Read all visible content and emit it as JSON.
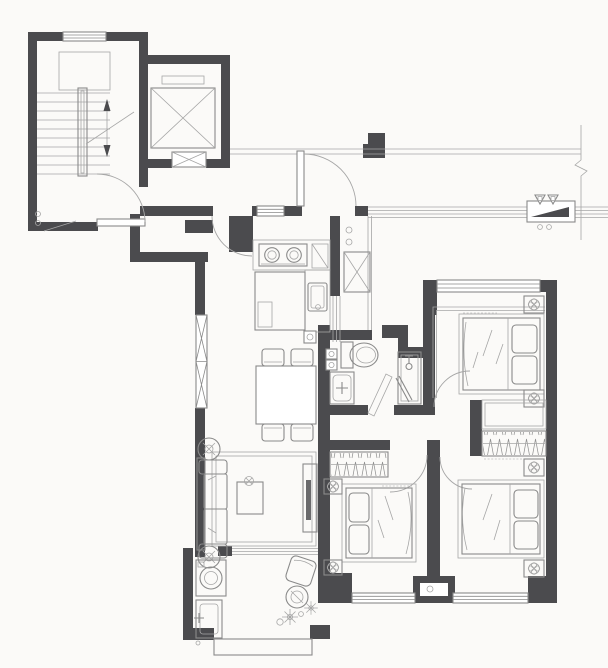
{
  "meta": {
    "title": "apartment-floor-plan",
    "description": "black-and-white architectural floor plan drawing, no text labels visible",
    "image_size": {
      "width": 608,
      "height": 668
    }
  },
  "palette": {
    "bg": "#fbfaf8",
    "wall": "#4b4b4e",
    "line": "#8a8a8a",
    "line2": "#a6a6a6",
    "hatch": "#8f8f8f"
  },
  "areas": [
    {
      "id": "stairwell",
      "label": "staircase with central handrail, treads and up/down arrows"
    },
    {
      "id": "elevator",
      "label": "elevator shaft with X-crossed cab and door symbol"
    },
    {
      "id": "lobby",
      "label": "shared landing lobby with two swing doors"
    },
    {
      "id": "corridor",
      "label": "open-air corridor with pillar, meter box and boundary break line"
    },
    {
      "id": "entry-hall",
      "label": "apartment entry hall with outward swinging entry door"
    },
    {
      "id": "kitchen",
      "label": "kitchen: two-burner gas stove, sink counter, island counter, duct shaft, sliding door, gas pipe circles"
    },
    {
      "id": "bathroom",
      "label": "bathroom: toilet with tank, washbasin with cross faucet, shower with glass door, diagonal threshold"
    },
    {
      "id": "dining",
      "label": "dining area: rectangular table with four chairs, west window with X mullions"
    },
    {
      "id": "living",
      "label": "living room: two-seat sofa, two round planters, area rug, hatched coffee table, TV cabinet"
    },
    {
      "id": "balcony",
      "label": "balcony: washing machine, laundry sink, lounge chair, round table, plants, hatched railing"
    },
    {
      "id": "bedroom-1",
      "label": "north-east bedroom: double bed head east, two nightstand lamps, north window, hatched bay grille"
    },
    {
      "id": "bedroom-2",
      "label": "south-middle bedroom: double bed head west, wardrobe hatch, two nightstand lamps, south window"
    },
    {
      "id": "bedroom-3",
      "label": "south-east bedroom: double bed head east, wardrobe hatch, two nightstand lamps, south window"
    }
  ],
  "fixtures": [
    "stair-treads",
    "stair-arrows",
    "elevator-cab",
    "entry-door-arc",
    "gas-stove",
    "kitchen-sink",
    "duct-shaft",
    "toilet",
    "washbasin",
    "shower",
    "dining-table",
    "sofa",
    "coffee-table",
    "tv-cabinet",
    "washing-machine",
    "laundry-sink",
    "balcony-railing",
    "bed",
    "nightstand-lamp",
    "wardrobe",
    "meter-box",
    "boundary-break"
  ]
}
